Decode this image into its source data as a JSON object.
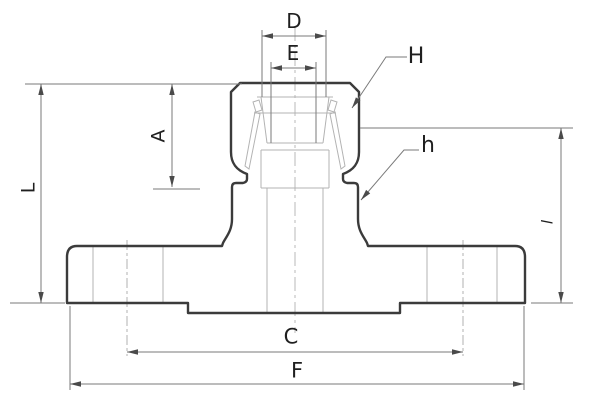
{
  "figure": {
    "type": "engineering-drawing",
    "dimension_labels": {
      "D": "D",
      "E": "E",
      "A": "A",
      "L": "L",
      "l": "l",
      "C": "C",
      "F": "F"
    },
    "callout_labels": {
      "H": "H",
      "h": "h"
    },
    "colors": {
      "background": "#ffffff",
      "outline": "#3b3b3b",
      "thin_line": "#b3b3b3",
      "dimension_line": "#7a7a7a",
      "label_text": "#1f1f1f"
    }
  }
}
